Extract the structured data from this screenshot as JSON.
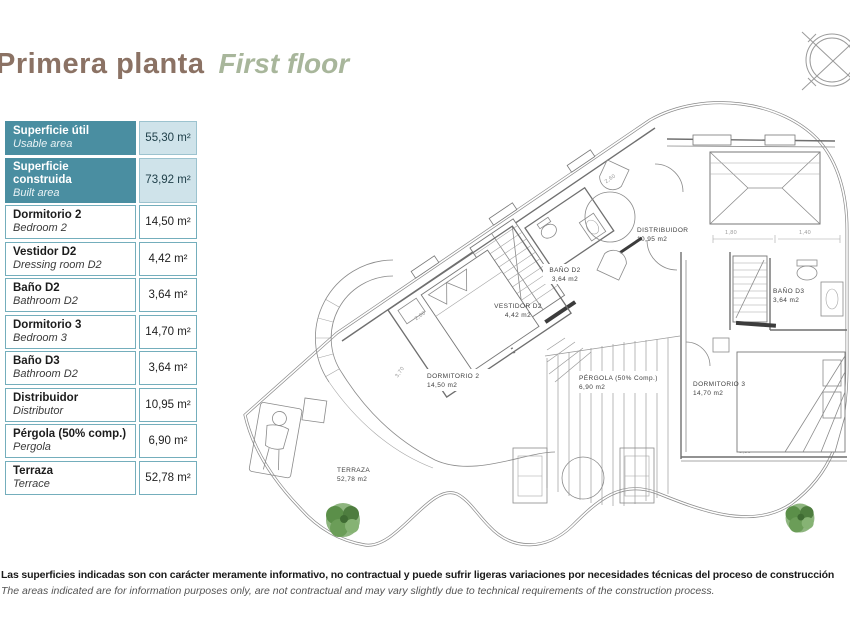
{
  "title": {
    "es": "Primera planta",
    "en": "First floor"
  },
  "area_table": {
    "rows": [
      {
        "es": "Superficie útil",
        "en": "Usable area",
        "value": "55,30 m²",
        "header": true
      },
      {
        "es": "Superficie construida",
        "en": "Built area",
        "value": "73,92 m²",
        "header": true
      },
      {
        "es": "Dormitorio 2",
        "en": "Bedroom 2",
        "value": "14,50 m²",
        "header": false
      },
      {
        "es": "Vestidor D2",
        "en": "Dressing room D2",
        "value": "4,42 m²",
        "header": false
      },
      {
        "es": "Baño D2",
        "en": "Bathroom D2",
        "value": "3,64 m²",
        "header": false
      },
      {
        "es": "Dormitorio 3",
        "en": "Bedroom 3",
        "value": "14,70 m²",
        "header": false
      },
      {
        "es": "Baño D3",
        "en": "Bathroom D2",
        "value": "3,64 m²",
        "header": false
      },
      {
        "es": "Distribuidor",
        "en": "Distributor",
        "value": "10,95 m²",
        "header": false
      },
      {
        "es": "Pérgola (50% comp.)",
        "en": "Pergola",
        "value": "6,90 m²",
        "header": false
      },
      {
        "es": "Terraza",
        "en": "Terrace",
        "value": "52,78 m²",
        "header": false
      }
    ]
  },
  "plan": {
    "rooms": [
      {
        "name": "DORMITORIO 2",
        "area": "14,50 m2"
      },
      {
        "name": "VESTIDOR D2",
        "area": "4,42 m2"
      },
      {
        "name": "BAÑO D2",
        "area": "3,64 m2"
      },
      {
        "name": "DISTRIBUIDOR",
        "area": "10,95 m2"
      },
      {
        "name": "BAÑO D3",
        "area": "3,64 m2"
      },
      {
        "name": "DORMITORIO 3",
        "area": "14,70 m2"
      },
      {
        "name": "PÉRGOLA (50% Comp.)",
        "area": "6,90 m2"
      },
      {
        "name": "TERRAZA",
        "area": "52,78 m2"
      }
    ],
    "dims": [
      "1,80",
      "1,40",
      "1,40",
      "2,00",
      "2,60",
      "3,70",
      "3,30"
    ],
    "icons": {
      "compass": "compass-rose",
      "tree": "plan-tree"
    }
  },
  "disclaimer": {
    "es": "Las superficies indicadas son con carácter meramente informativo, no contractual y puede sufrir ligeras variaciones por necesidades técnicas del proceso de construcción",
    "en": "The areas indicated are for information purposes only, are not contractual and may vary slightly due to technical requirements of the construction process."
  },
  "colors": {
    "teal": "#4a8ea1",
    "light_blue": "#cfe3ea",
    "cell_border": "#74aebc",
    "title_brown": "#8b7264",
    "title_green": "#a8b69b",
    "tree_green": "#5f8f4d",
    "line_gray": "#7a7a7a"
  }
}
